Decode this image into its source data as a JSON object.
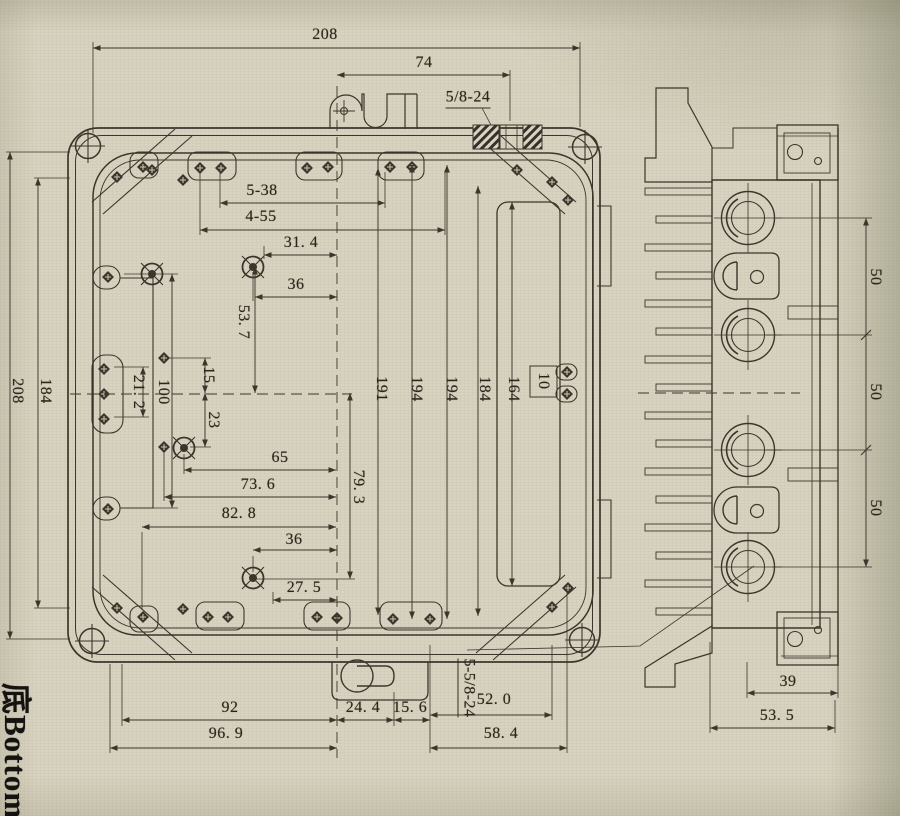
{
  "colors": {
    "paper": "#d8d3c0",
    "ink": "#3b362c"
  },
  "caption": {
    "bottom_view_label": "底Bottom"
  },
  "labels": {
    "top_width": "208",
    "tab_width": "74",
    "thread_top": "5/8-24",
    "holes_a": "5-38",
    "holes_b": "4-55",
    "w31_4": "31. 4",
    "w36_top": "36",
    "h53_7": "53. 7",
    "h15": "15",
    "h23": "23",
    "h100": "100",
    "h21_2": "21. 2",
    "left_height": "208",
    "left_inner_height": "184",
    "w65": "65",
    "w73_6": "73. 6",
    "w82_8": "82. 8",
    "w36_bot": "36",
    "w27_5": "27. 5",
    "h79_3": "79. 3",
    "h191": "191",
    "h194_a": "194",
    "h194_b": "194",
    "h184_mid": "184",
    "h164": "164",
    "h10": "10",
    "w92": "92",
    "w96_9": "96. 9",
    "w24_4": "24. 4",
    "w15_6": "15. 6",
    "w52_0": "52. 0",
    "w58_4": "58. 4",
    "thread_bottom": "5-5/8-24",
    "port_spacing_a": "50",
    "port_spacing_b": "50",
    "port_spacing_c": "50",
    "w39": "39",
    "w53_5": "53. 5"
  }
}
